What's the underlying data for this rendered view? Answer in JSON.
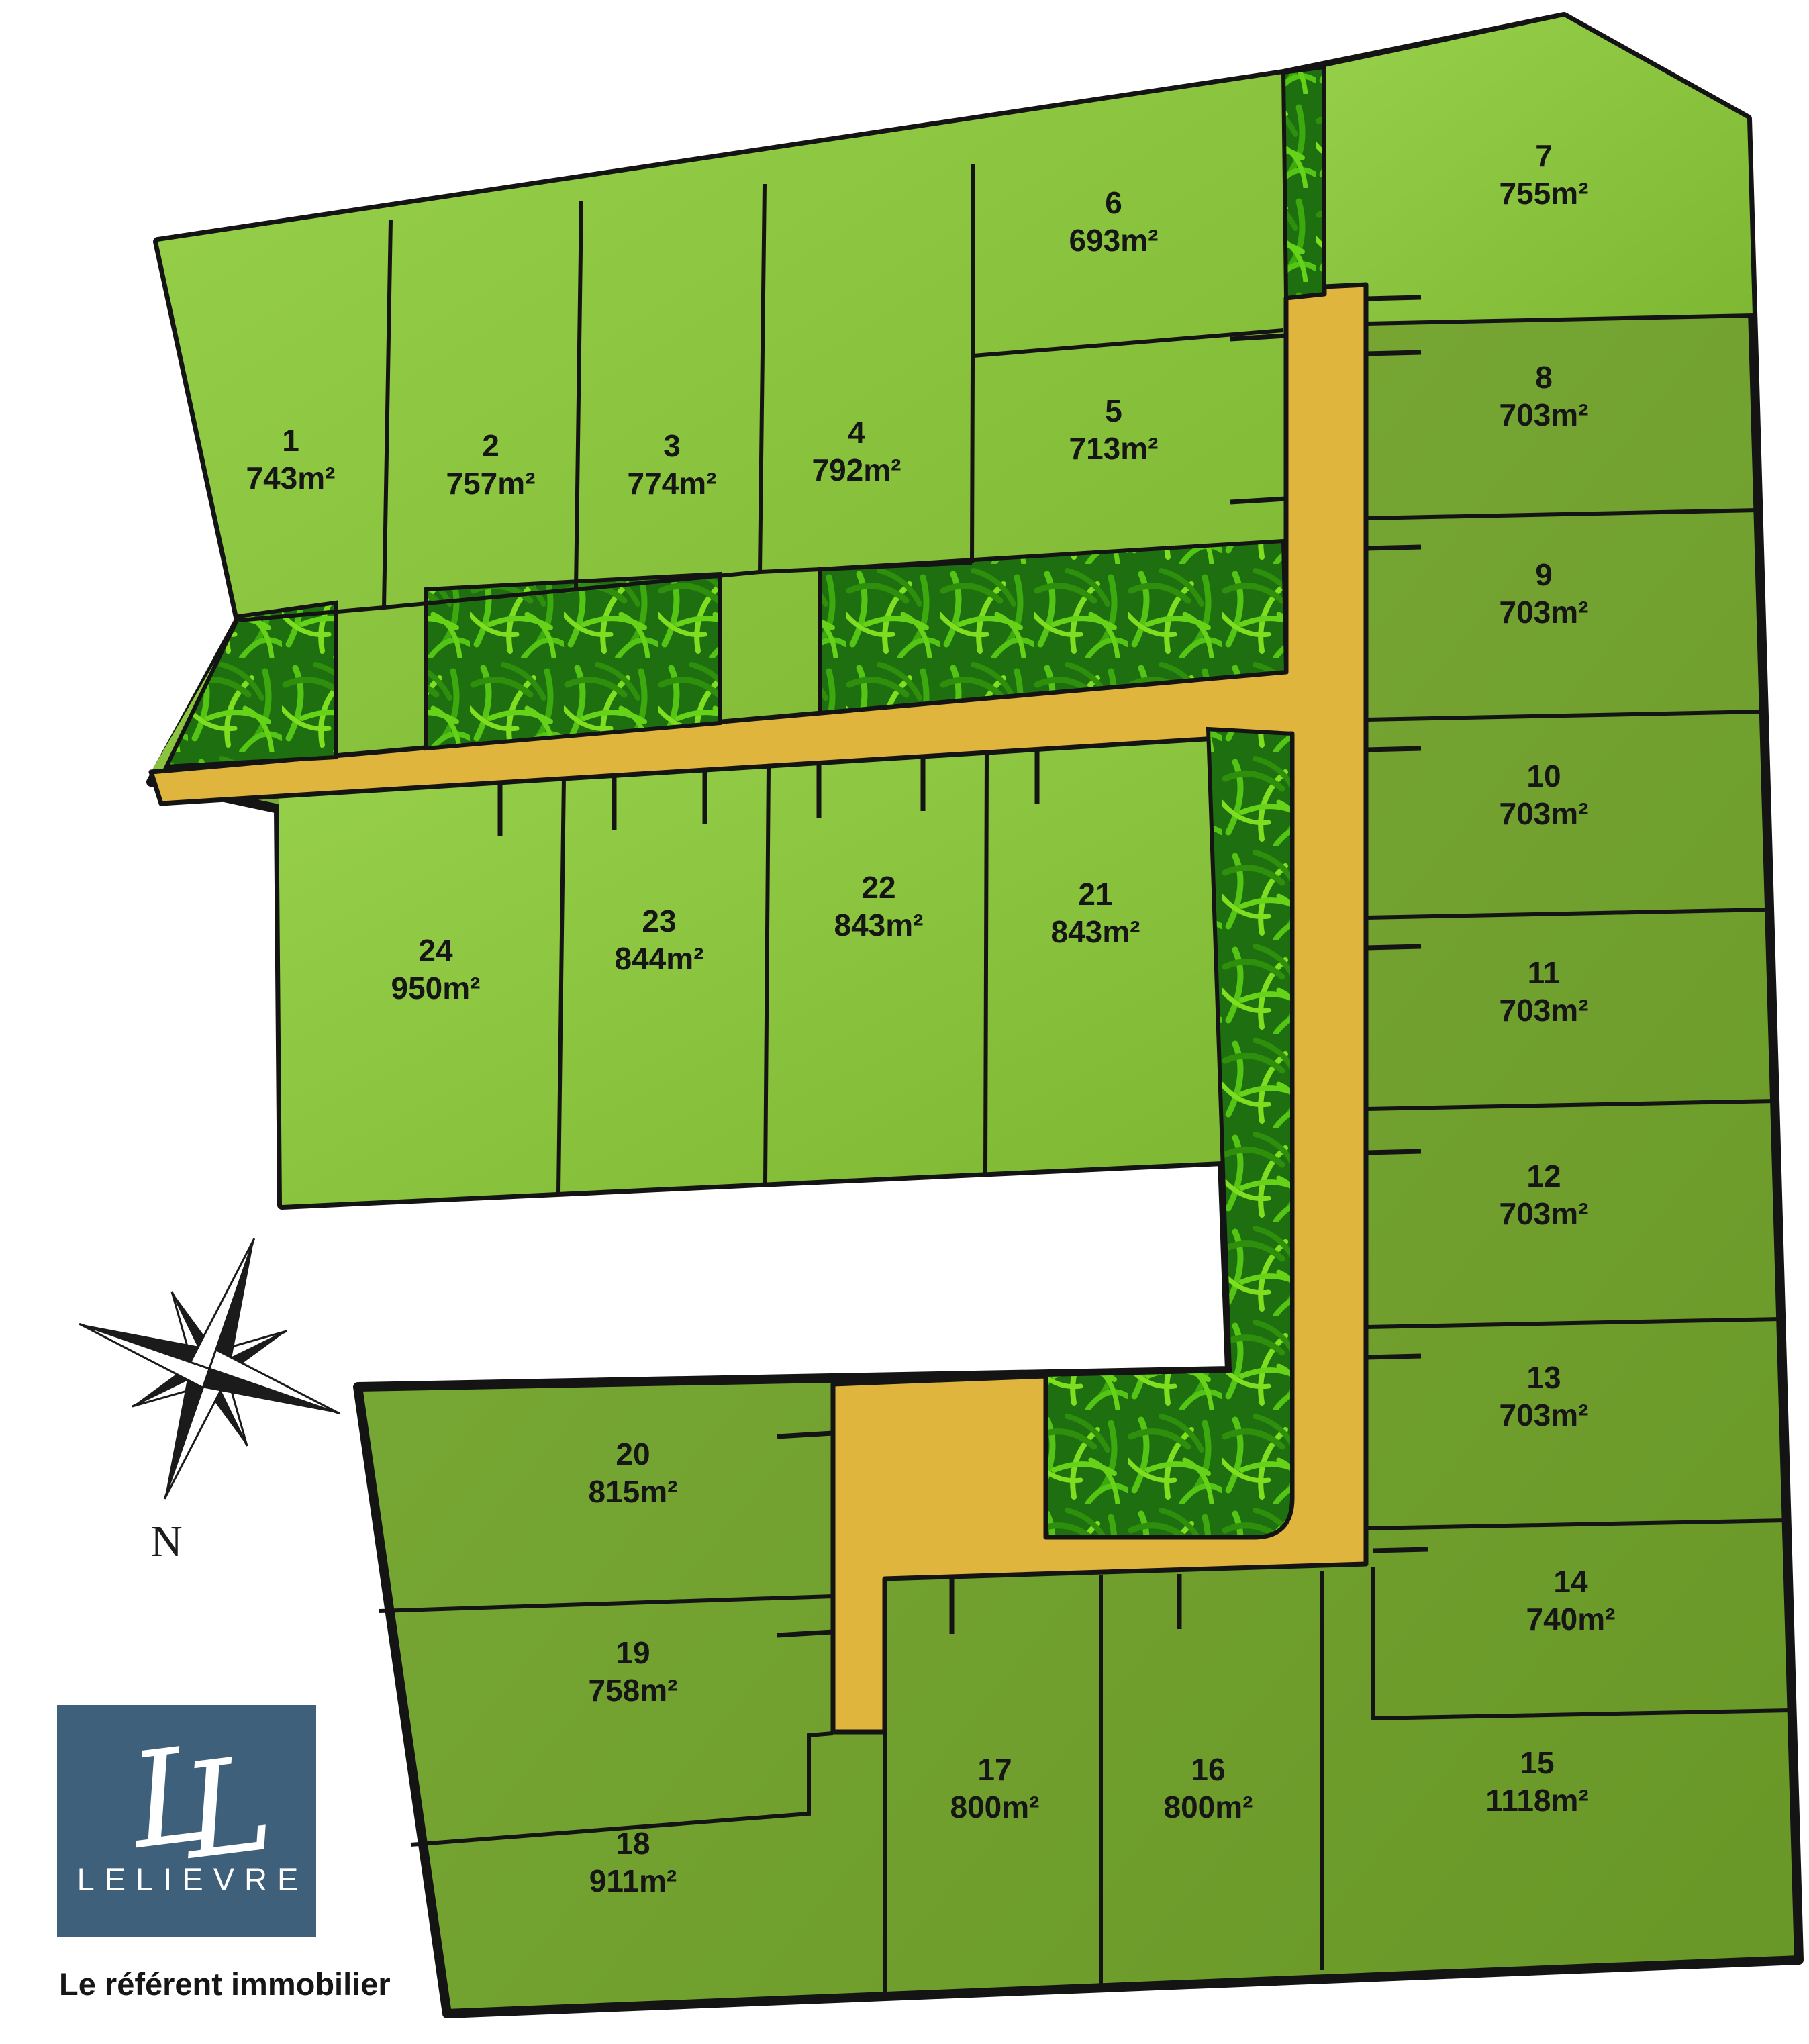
{
  "plan_type": "residential-subdivision-site-plan",
  "lots": [
    {
      "number": "1",
      "area": "743m²"
    },
    {
      "number": "2",
      "area": "757m²"
    },
    {
      "number": "3",
      "area": "774m²"
    },
    {
      "number": "4",
      "area": "792m²"
    },
    {
      "number": "5",
      "area": "713m²"
    },
    {
      "number": "6",
      "area": "693m²"
    },
    {
      "number": "7",
      "area": "755m²"
    },
    {
      "number": "8",
      "area": "703m²"
    },
    {
      "number": "9",
      "area": "703m²"
    },
    {
      "number": "10",
      "area": "703m²"
    },
    {
      "number": "11",
      "area": "703m²"
    },
    {
      "number": "12",
      "area": "703m²"
    },
    {
      "number": "13",
      "area": "703m²"
    },
    {
      "number": "14",
      "area": "740m²"
    },
    {
      "number": "15",
      "area": "1118m²"
    },
    {
      "number": "16",
      "area": "800m²"
    },
    {
      "number": "17",
      "area": "800m²"
    },
    {
      "number": "18",
      "area": "911m²"
    },
    {
      "number": "19",
      "area": "758m²"
    },
    {
      "number": "20",
      "area": "815m²"
    },
    {
      "number": "21",
      "area": "843m²"
    },
    {
      "number": "22",
      "area": "843m²"
    },
    {
      "number": "23",
      "area": "844m²"
    },
    {
      "number": "24",
      "area": "950m²"
    }
  ],
  "compass": {
    "label": "N"
  },
  "logo": {
    "monogram_left": "L",
    "monogram_right": "L",
    "name": "LELIEVRE",
    "tagline": "Le référent immobilier"
  },
  "colors": {
    "lot_green_bright": "#8CC63E",
    "lot_green_olive": "#74A832",
    "road_yellow": "#DFB53E",
    "hedge_green": "#1E6F10",
    "outline_black": "#141414",
    "logo_blue": "#3F607A",
    "background": "#FFFFFF"
  }
}
